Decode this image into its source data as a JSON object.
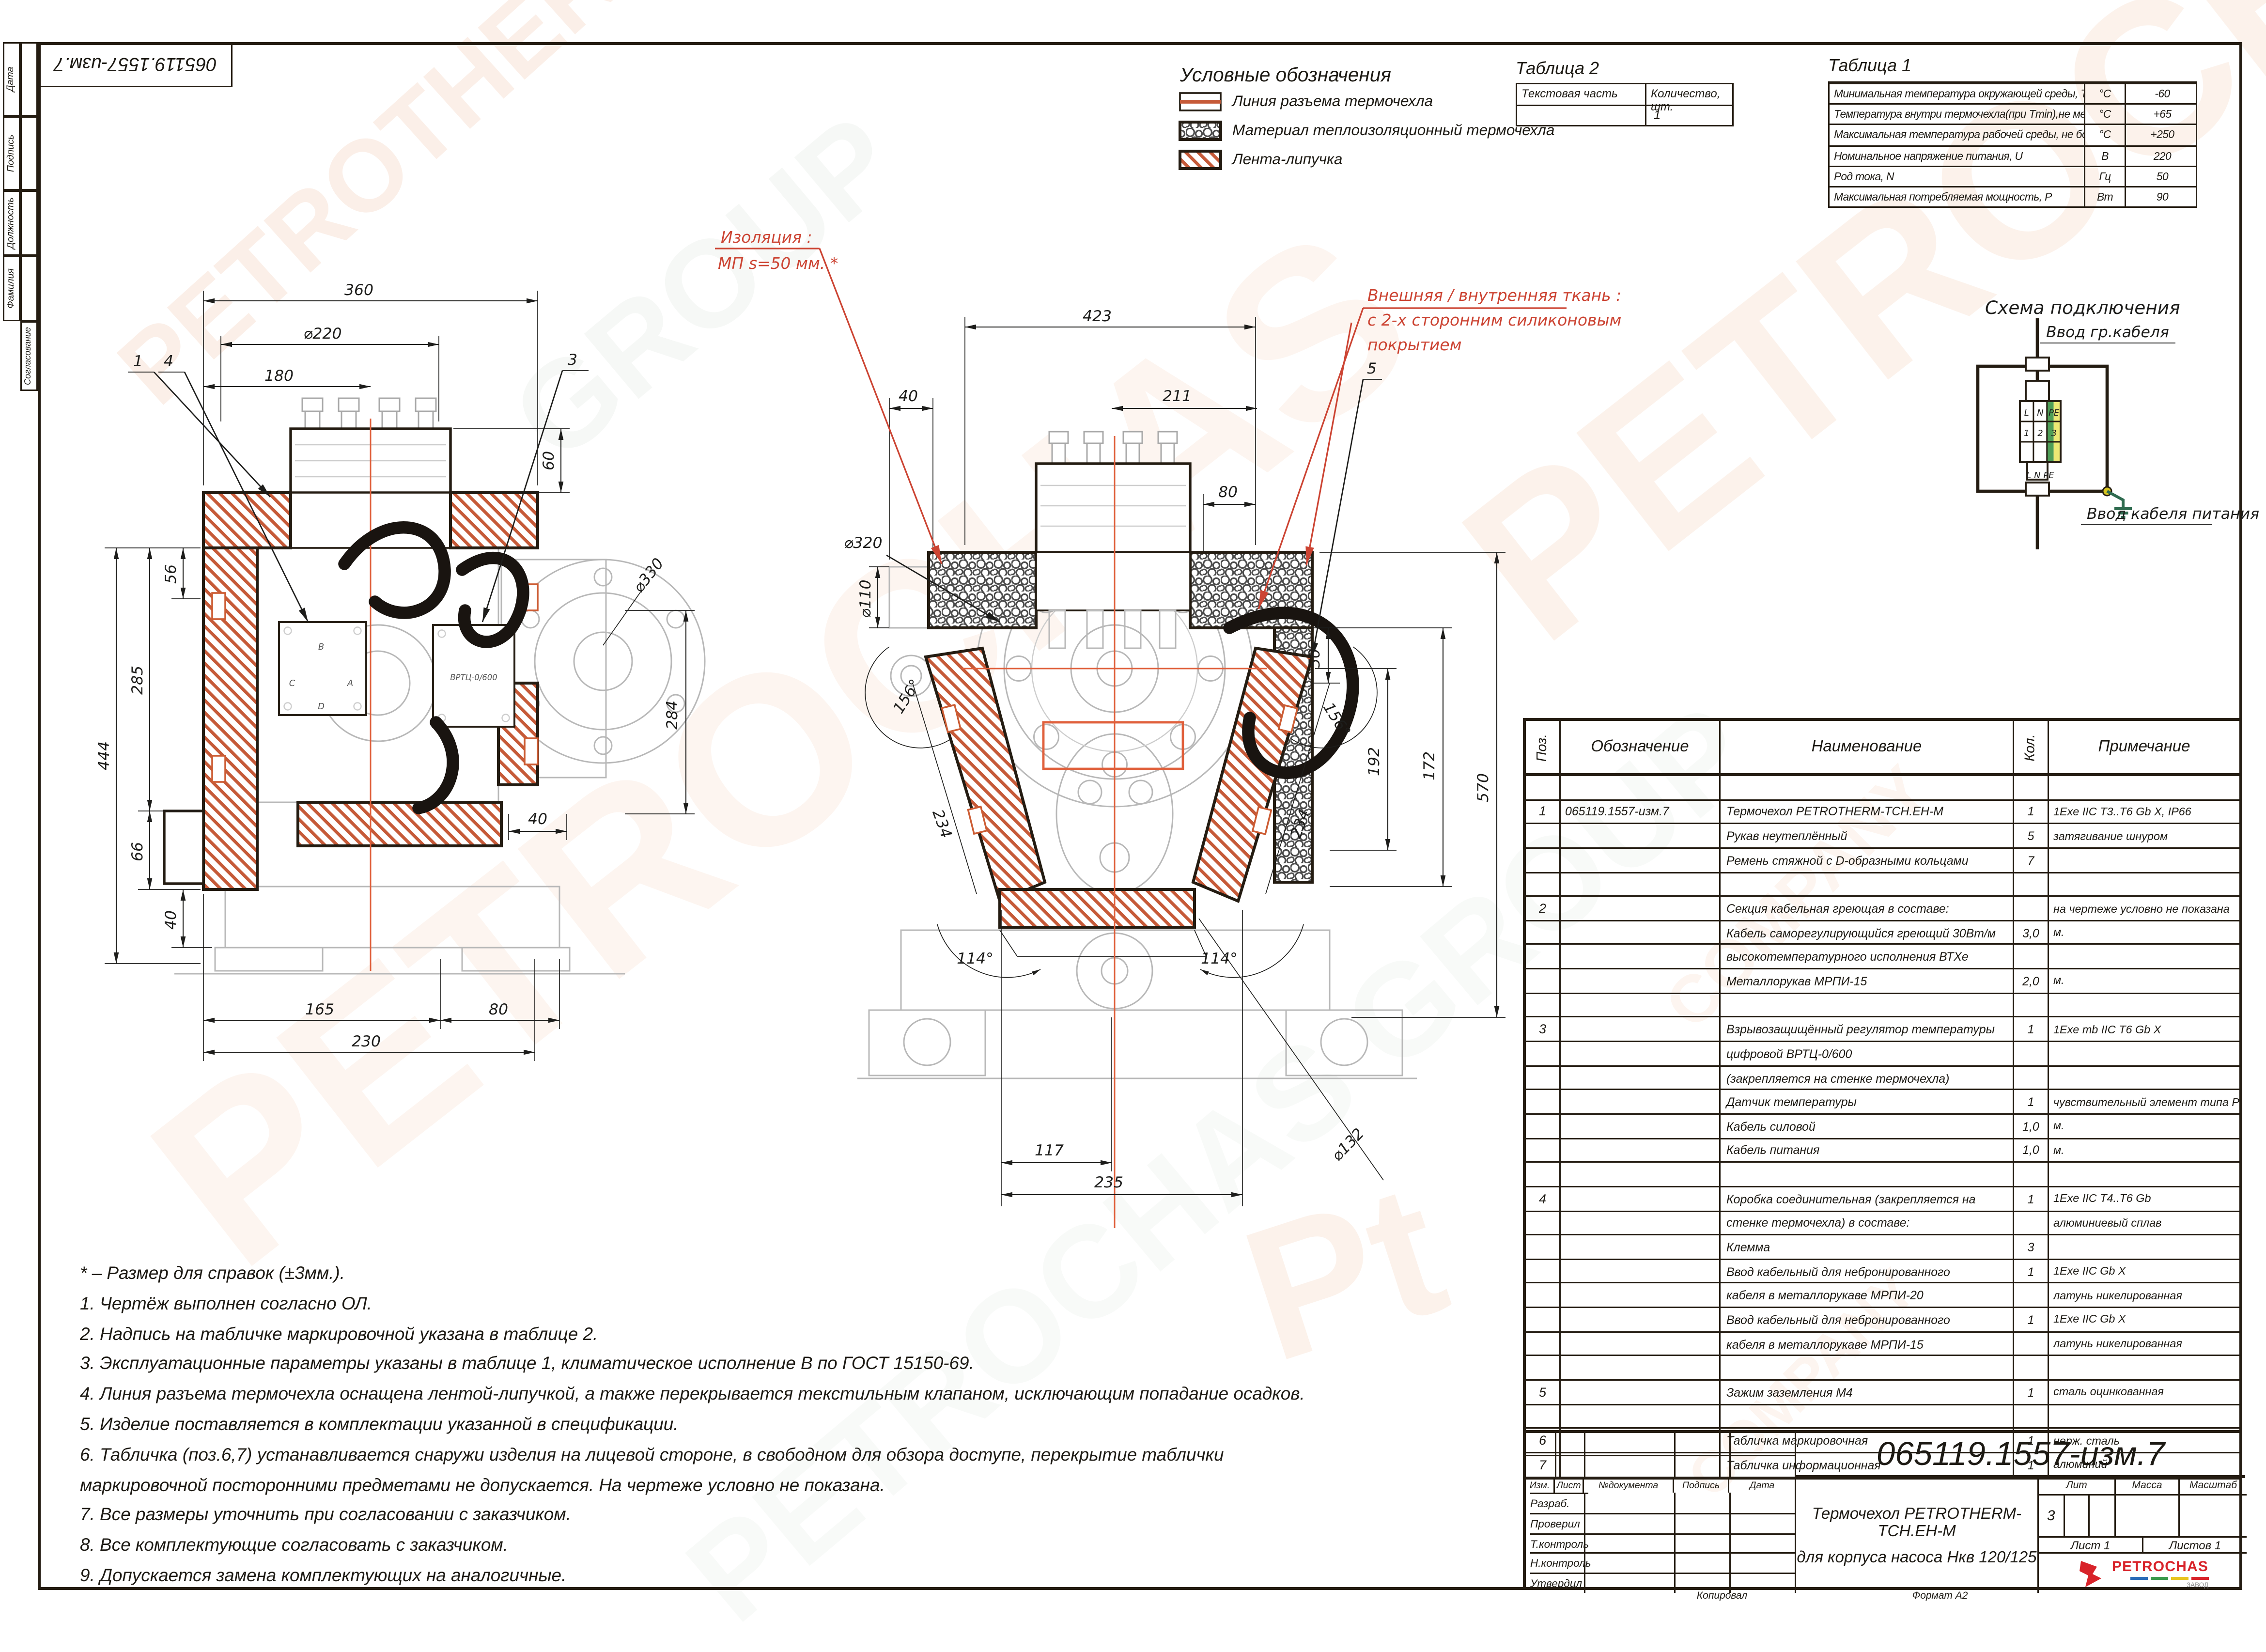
{
  "sheet": {
    "stamp": "065119.1557-изм.7",
    "kopiroval": "Копировал",
    "format": "Формат А2"
  },
  "sidebar": {
    "labels": [
      "Дата",
      "Подпись",
      "Должность",
      "Фамилия",
      "Согласование"
    ]
  },
  "watermarks": [
    "PETROCHAS",
    "PETROTHERM",
    "GROUP",
    "COMPANY",
    "Pt",
    "PETROCHAS",
    "COMPANY",
    "PETROCHAS GROUP"
  ],
  "legend": {
    "title": "Условные обозначения",
    "items": [
      {
        "label": "Линия разъема термочехла"
      },
      {
        "label": "Материал теплоизоляционный термочехла"
      },
      {
        "label": "Лента-липучка"
      }
    ]
  },
  "table2": {
    "title": "Таблица 2",
    "col1": "Текстовая часть",
    "col2": "Количество, шт.",
    "row_value": "1"
  },
  "table1": {
    "title": "Таблица 1",
    "rows": [
      {
        "param": "Минимальная температура окружающей среды, Tmin",
        "unit": "°С",
        "value": "-60"
      },
      {
        "param": "Температура внутри термочехла(при Tmin),не менее, Т",
        "unit": "°С",
        "value": "+65"
      },
      {
        "param": "Максимальная температура рабочей среды, не более, Tmax",
        "unit": "°С",
        "value": "+250"
      },
      {
        "param": "Номинальное напряжение питания, U",
        "unit": "В",
        "value": "220"
      },
      {
        "param": "Род тока, N",
        "unit": "Гц",
        "value": "50"
      },
      {
        "param": "Максимальная потребляемая мощность, P",
        "unit": "Вт",
        "value": "90"
      }
    ]
  },
  "schema": {
    "title": "Схема подключения",
    "top_label": "Ввод гр.кабеля",
    "bottom_label": "Ввод кабеля питания",
    "t1": "L",
    "t2": "N",
    "t3": "PE",
    "t4": "1",
    "t5": "2",
    "t6": "3",
    "bottom_terms": "L  N PE"
  },
  "annotations": {
    "insulation_line1": "Изоляция :",
    "insulation_line2": "МП  s=50 мм. *",
    "fabric_line1": "Внешняя / внутренняя ткань :",
    "fabric_line2": "с 2-х сторонним силиконовым",
    "fabric_line3": "покрытием",
    "callout_1": "1",
    "callout_4": "4",
    "callout_3": "3",
    "callout_5": "5"
  },
  "dims_left": {
    "w360": "360",
    "d220": "⌀220",
    "w180": "180",
    "h60": "60",
    "h56": "56",
    "h285": "285",
    "h444": "444",
    "h66": "66",
    "w40": "40",
    "w165": "165",
    "w230": "230",
    "w80": "80",
    "d330": "⌀330",
    "h284": "284",
    "w40b": "40",
    "vrtc": "ВРТЦ-0/600",
    "jb": [
      "B",
      "C",
      "A",
      "D"
    ]
  },
  "dims_front": {
    "w423": "423",
    "w40": "40",
    "w211": "211",
    "w80": "80",
    "d110": "⌀110",
    "d320": "⌀320",
    "h50": "50",
    "h172": "172",
    "h192": "192",
    "h570": "570",
    "a156l": "156°",
    "a156r": "156°",
    "d234l": "234",
    "d234r": "234",
    "a114l": "114°",
    "a114r": "114°",
    "w117": "117",
    "w235": "235",
    "d132": "⌀132"
  },
  "parts": {
    "headers": {
      "pos": "Поз.",
      "desig": "Обозначение",
      "name": "Наименование",
      "qty": "Кол.",
      "note": "Примечание"
    },
    "rows": [
      {
        "p": "",
        "o": "",
        "n": "",
        "k": "",
        "pr": ""
      },
      {
        "p": "1",
        "o": "065119.1557-изм.7",
        "n": "Термочехол PETROTHERM-TCH.EH-M",
        "k": "1",
        "pr": "1Exe IIC T3..T6 Gb X, IP66"
      },
      {
        "p": "",
        "o": "",
        "n": "Рукав неутеплённый",
        "k": "5",
        "pr": "затягивание шнуром"
      },
      {
        "p": "",
        "o": "",
        "n": "Ремень стяжной с D-образными кольцами",
        "k": "7",
        "pr": ""
      },
      {
        "p": "",
        "o": "",
        "n": "",
        "k": "",
        "pr": ""
      },
      {
        "p": "2",
        "o": "",
        "n": "Секция кабельная греющая в составе:",
        "k": "",
        "pr": "на чертеже условно не показана"
      },
      {
        "p": "",
        "o": "",
        "n": "Кабель саморегулирующийся греющий 30Вт/м",
        "k": "3,0",
        "pr": "м."
      },
      {
        "p": "",
        "o": "",
        "n": "высокотемпературного исполнения ВТХе",
        "k": "",
        "pr": ""
      },
      {
        "p": "",
        "o": "",
        "n": "Металлорукав МРПИ-15",
        "k": "2,0",
        "pr": "м."
      },
      {
        "p": "",
        "o": "",
        "n": "",
        "k": "",
        "pr": ""
      },
      {
        "p": "3",
        "o": "",
        "n": "Взрывозащищённый регулятор температуры",
        "k": "1",
        "pr": "1Exe mb IIC T6 Gb X"
      },
      {
        "p": "",
        "o": "",
        "n": "цифровой ВРТЦ-0/600",
        "k": "",
        "pr": ""
      },
      {
        "p": "",
        "o": "",
        "n": "(закрепляется на стенке термочехла)",
        "k": "",
        "pr": ""
      },
      {
        "p": "",
        "o": "",
        "n": "Датчик температуры",
        "k": "1",
        "pr": "чувствительный элемент типа PT100"
      },
      {
        "p": "",
        "o": "",
        "n": "Кабель силовой",
        "k": "1,0",
        "pr": "м."
      },
      {
        "p": "",
        "o": "",
        "n": "Кабель питания",
        "k": "1,0",
        "pr": "м."
      },
      {
        "p": "",
        "o": "",
        "n": "",
        "k": "",
        "pr": ""
      },
      {
        "p": "4",
        "o": "",
        "n": "Коробка соединительная (закрепляется на",
        "k": "1",
        "pr": "1Exe IIC T4..T6 Gb"
      },
      {
        "p": "",
        "o": "",
        "n": "стенке термочехла) в составе:",
        "k": "",
        "pr": "алюминиевый сплав"
      },
      {
        "p": "",
        "o": "",
        "n": "Клемма",
        "k": "3",
        "pr": ""
      },
      {
        "p": "",
        "o": "",
        "n": "Ввод кабельный для небронированного",
        "k": "1",
        "pr": "1Exe IIC Gb X"
      },
      {
        "p": "",
        "o": "",
        "n": "кабеля в металлорукаве МРПИ-20",
        "k": "",
        "pr": "латунь никелированная"
      },
      {
        "p": "",
        "o": "",
        "n": "Ввод кабельный для небронированного",
        "k": "1",
        "pr": "1Exe IIC Gb X"
      },
      {
        "p": "",
        "o": "",
        "n": "кабеля в металлорукаве МРПИ-15",
        "k": "",
        "pr": "латунь никелированная"
      },
      {
        "p": "",
        "o": "",
        "n": "",
        "k": "",
        "pr": ""
      },
      {
        "p": "5",
        "o": "",
        "n": "Зажим заземления М4",
        "k": "1",
        "pr": "сталь оцинкованная"
      },
      {
        "p": "",
        "o": "",
        "n": "",
        "k": "",
        "pr": ""
      },
      {
        "p": "6",
        "o": "",
        "n": "Табличка маркировочная",
        "k": "1",
        "pr": "нерж. сталь"
      },
      {
        "p": "7",
        "o": "",
        "n": "Табличка информационная",
        "k": "1",
        "pr": "алюминий"
      }
    ]
  },
  "title_block": {
    "doc_number": "065119.1557-изм.7",
    "header_cols": [
      "Изм.",
      "Лист",
      "№документа",
      "Подпись",
      "Дата"
    ],
    "row_labels": [
      "Разраб.",
      "Проверил",
      "Т.контроль",
      "Н.контроль",
      "Утвердил"
    ],
    "title_line1": "Термочехол PETROTHERM-TCH.EH-M",
    "title_line2": "для корпуса насоса Нкв 120/125",
    "lit_label": "Лит",
    "mass_label": "Масса",
    "scale_label": "Масштаб",
    "lit_value": "3",
    "sheet_label": "Лист 1",
    "sheets_label": "Листов  1",
    "logo_text": "PETROCHAS",
    "logo_sub": "ЗАВОД"
  },
  "notes": [
    "* – Размер для справок (±3мм.).",
    "1. Чертёж выполнен согласно ОЛ.",
    "2. Надпись на табличке маркировочной указана в таблице 2.",
    "3. Эксплуатационные параметры указаны в таблице 1, климатическое исполнение В по ГОСТ 15150-69.",
    "4. Линия разъема термочехла оснащена лентой-липучкой, а также перекрывается текстильным клапаном, исключающим попадание осадков.",
    "5. Изделие поставляется в комплектации указанной в спецификации.",
    "6. Табличка (поз.6,7) устанавливается снаружи изделия на лицевой стороне, в свободном для обзора доступе, перекрытие таблички",
    "маркировочной посторонними предметами не допускается. На чертеже условно не показана.",
    "7. Все размеры уточнить при согласовании с заказчиком.",
    "8. Все комплектующие согласовать с заказчиком.",
    "9. Допускается замена комплектующих на аналогичные."
  ]
}
